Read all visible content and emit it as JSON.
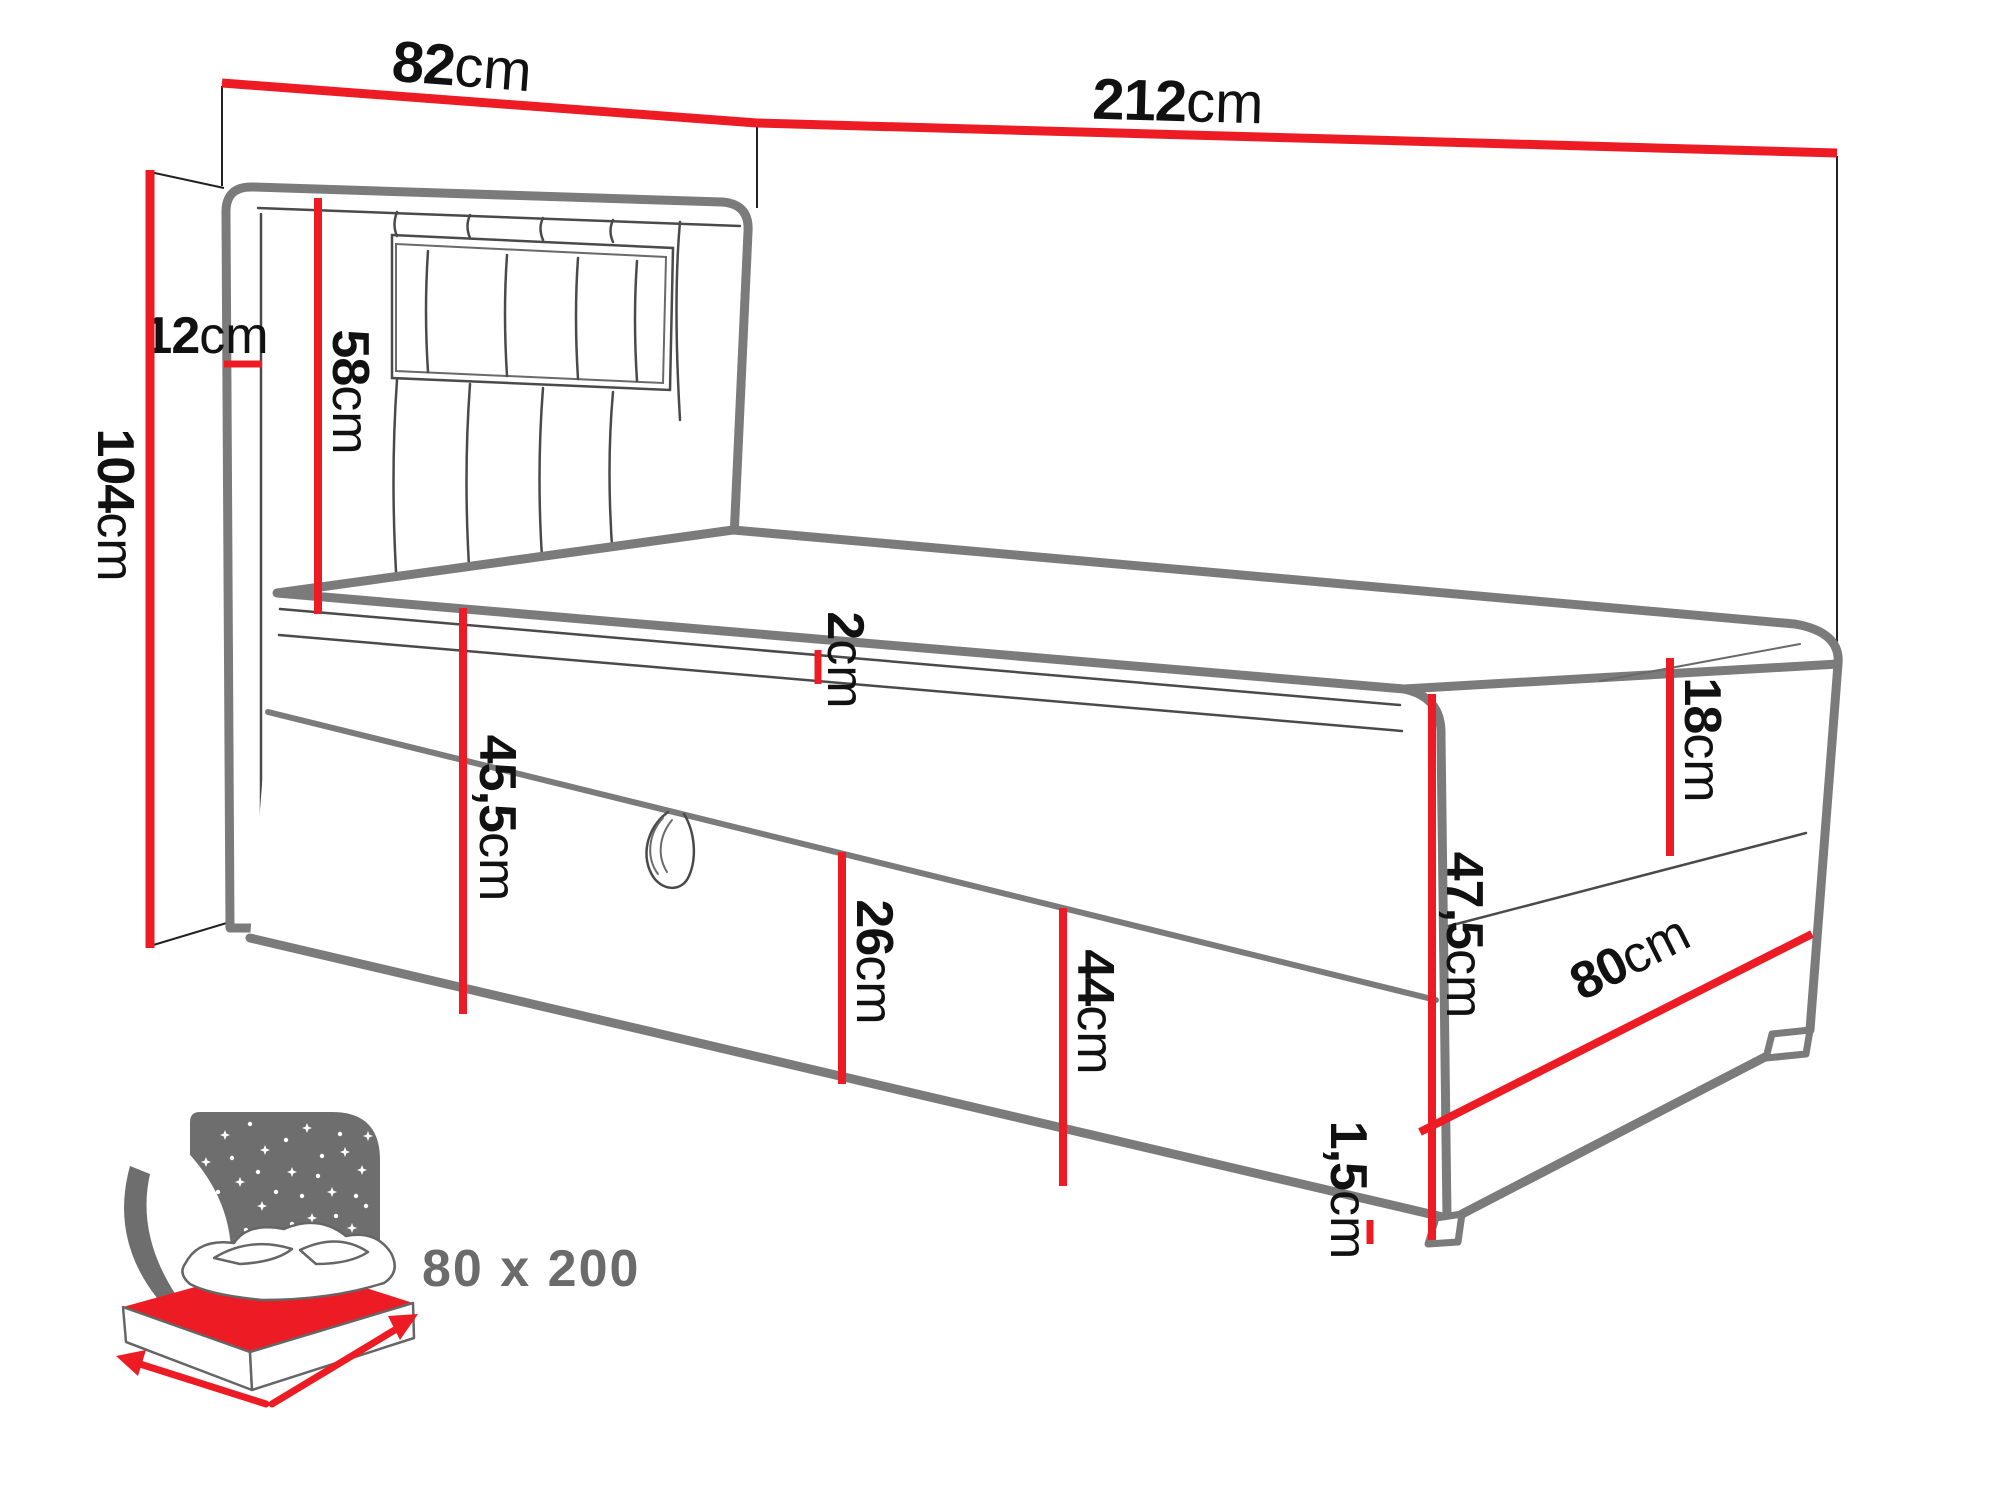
{
  "diagram": {
    "dimensions": [
      {
        "id": "headboard-width",
        "value": "82",
        "unit": "cm"
      },
      {
        "id": "total-length",
        "value": "212",
        "unit": "cm"
      },
      {
        "id": "headboard-depth",
        "value": "12",
        "unit": "cm"
      },
      {
        "id": "total-height",
        "value": "104",
        "unit": "cm"
      },
      {
        "id": "headboard-height",
        "value": "58",
        "unit": "cm"
      },
      {
        "id": "topper-height",
        "value": "2",
        "unit": "cm"
      },
      {
        "id": "base-side-height",
        "value": "45,5",
        "unit": "cm"
      },
      {
        "id": "storage-height",
        "value": "26",
        "unit": "cm"
      },
      {
        "id": "box-front-height",
        "value": "44",
        "unit": "cm"
      },
      {
        "id": "corner-height",
        "value": "47,5",
        "unit": "cm"
      },
      {
        "id": "mattress-height",
        "value": "18",
        "unit": "cm"
      },
      {
        "id": "bed-width",
        "value": "80",
        "unit": "cm"
      },
      {
        "id": "feet-height",
        "value": "1,5",
        "unit": "cm"
      }
    ],
    "sleeping_area": {
      "label": "80 x 200"
    },
    "colors": {
      "dimension_red": "#ed1c24",
      "outline_gray": "#7b7b7b",
      "detail_gray": "#4a4a4a",
      "icon_gray": "#6e6e6e",
      "label_black": "#111111",
      "size_label_gray": "#6b6b6b"
    }
  }
}
